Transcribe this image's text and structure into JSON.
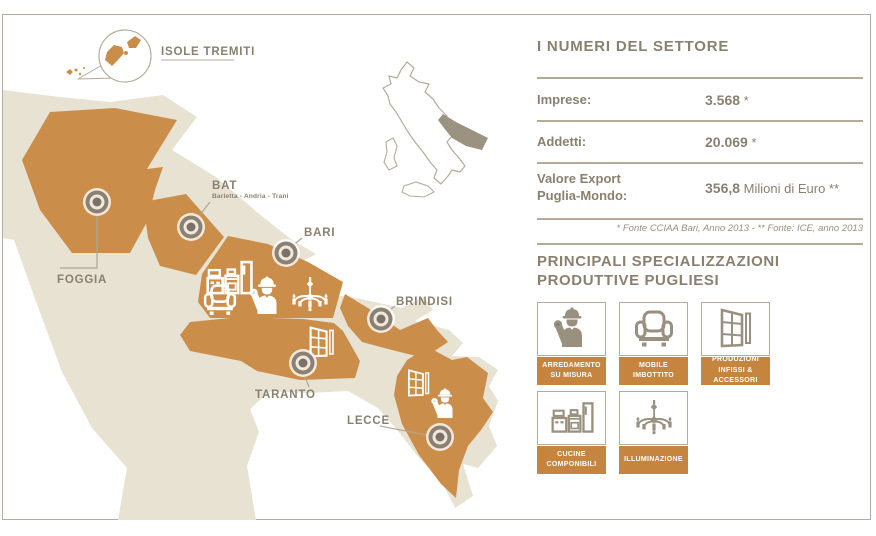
{
  "colors": {
    "orange": "#CB8E4A",
    "beige": "#E8E2D3",
    "taupe_text": "#8A8070",
    "line": "#B5AB99",
    "card_bar": "#C5853F",
    "icon_gray": "#9A9080",
    "marker_ring": "#8A8173",
    "marker_dot": "#7B7265",
    "marker_inner": "#EFE9DD",
    "minimap_region": "#9C9281"
  },
  "map": {
    "callout": {
      "label": "ISOLE TREMITI"
    },
    "provinces": [
      {
        "id": "foggia",
        "label": "FOGGIA"
      },
      {
        "id": "bat",
        "label": "BAT",
        "sublabel": "Barletta - Andria - Trani"
      },
      {
        "id": "bari",
        "label": "BARI"
      },
      {
        "id": "brindisi",
        "label": "BRINDISI"
      },
      {
        "id": "taranto",
        "label": "TARANTO"
      },
      {
        "id": "lecce",
        "label": "LECCE"
      }
    ]
  },
  "panel": {
    "numbers": {
      "title": "I NUMERI DEL SETTORE",
      "rows": [
        {
          "label_line1": "Imprese:",
          "label_line2": "",
          "value": "3.568",
          "suffix": " *"
        },
        {
          "label_line1": "Addetti:",
          "label_line2": "",
          "value": "20.069",
          "suffix": " *"
        },
        {
          "label_line1": "Valore Export",
          "label_line2": "Puglia-Mondo:",
          "value": "356,8",
          "suffix": " Milioni di Euro **"
        }
      ],
      "footnote": "* Fonte CCIAA Bari, Anno 2013  - ** Fonte: ICE, anno 2013"
    },
    "specializations": {
      "title_line1": "PRINCIPALI SPECIALIZZAZIONI",
      "title_line2": "PRODUTTIVE PUGLIESI",
      "cards": [
        {
          "icon": "worker-icon",
          "label": "ARREDAMENTO\nSU MISURA"
        },
        {
          "icon": "armchair-icon",
          "label": "MOBILE\nIMBOTTITO"
        },
        {
          "icon": "window-icon",
          "label": "PRODUZIONI\nINFISSI & ACCESSORI"
        },
        {
          "icon": "kitchen-icon",
          "label": "CUCINE\nCOMPONIBILI"
        },
        {
          "icon": "chandelier-icon",
          "label": "ILLUMINAZIONE"
        }
      ]
    }
  }
}
